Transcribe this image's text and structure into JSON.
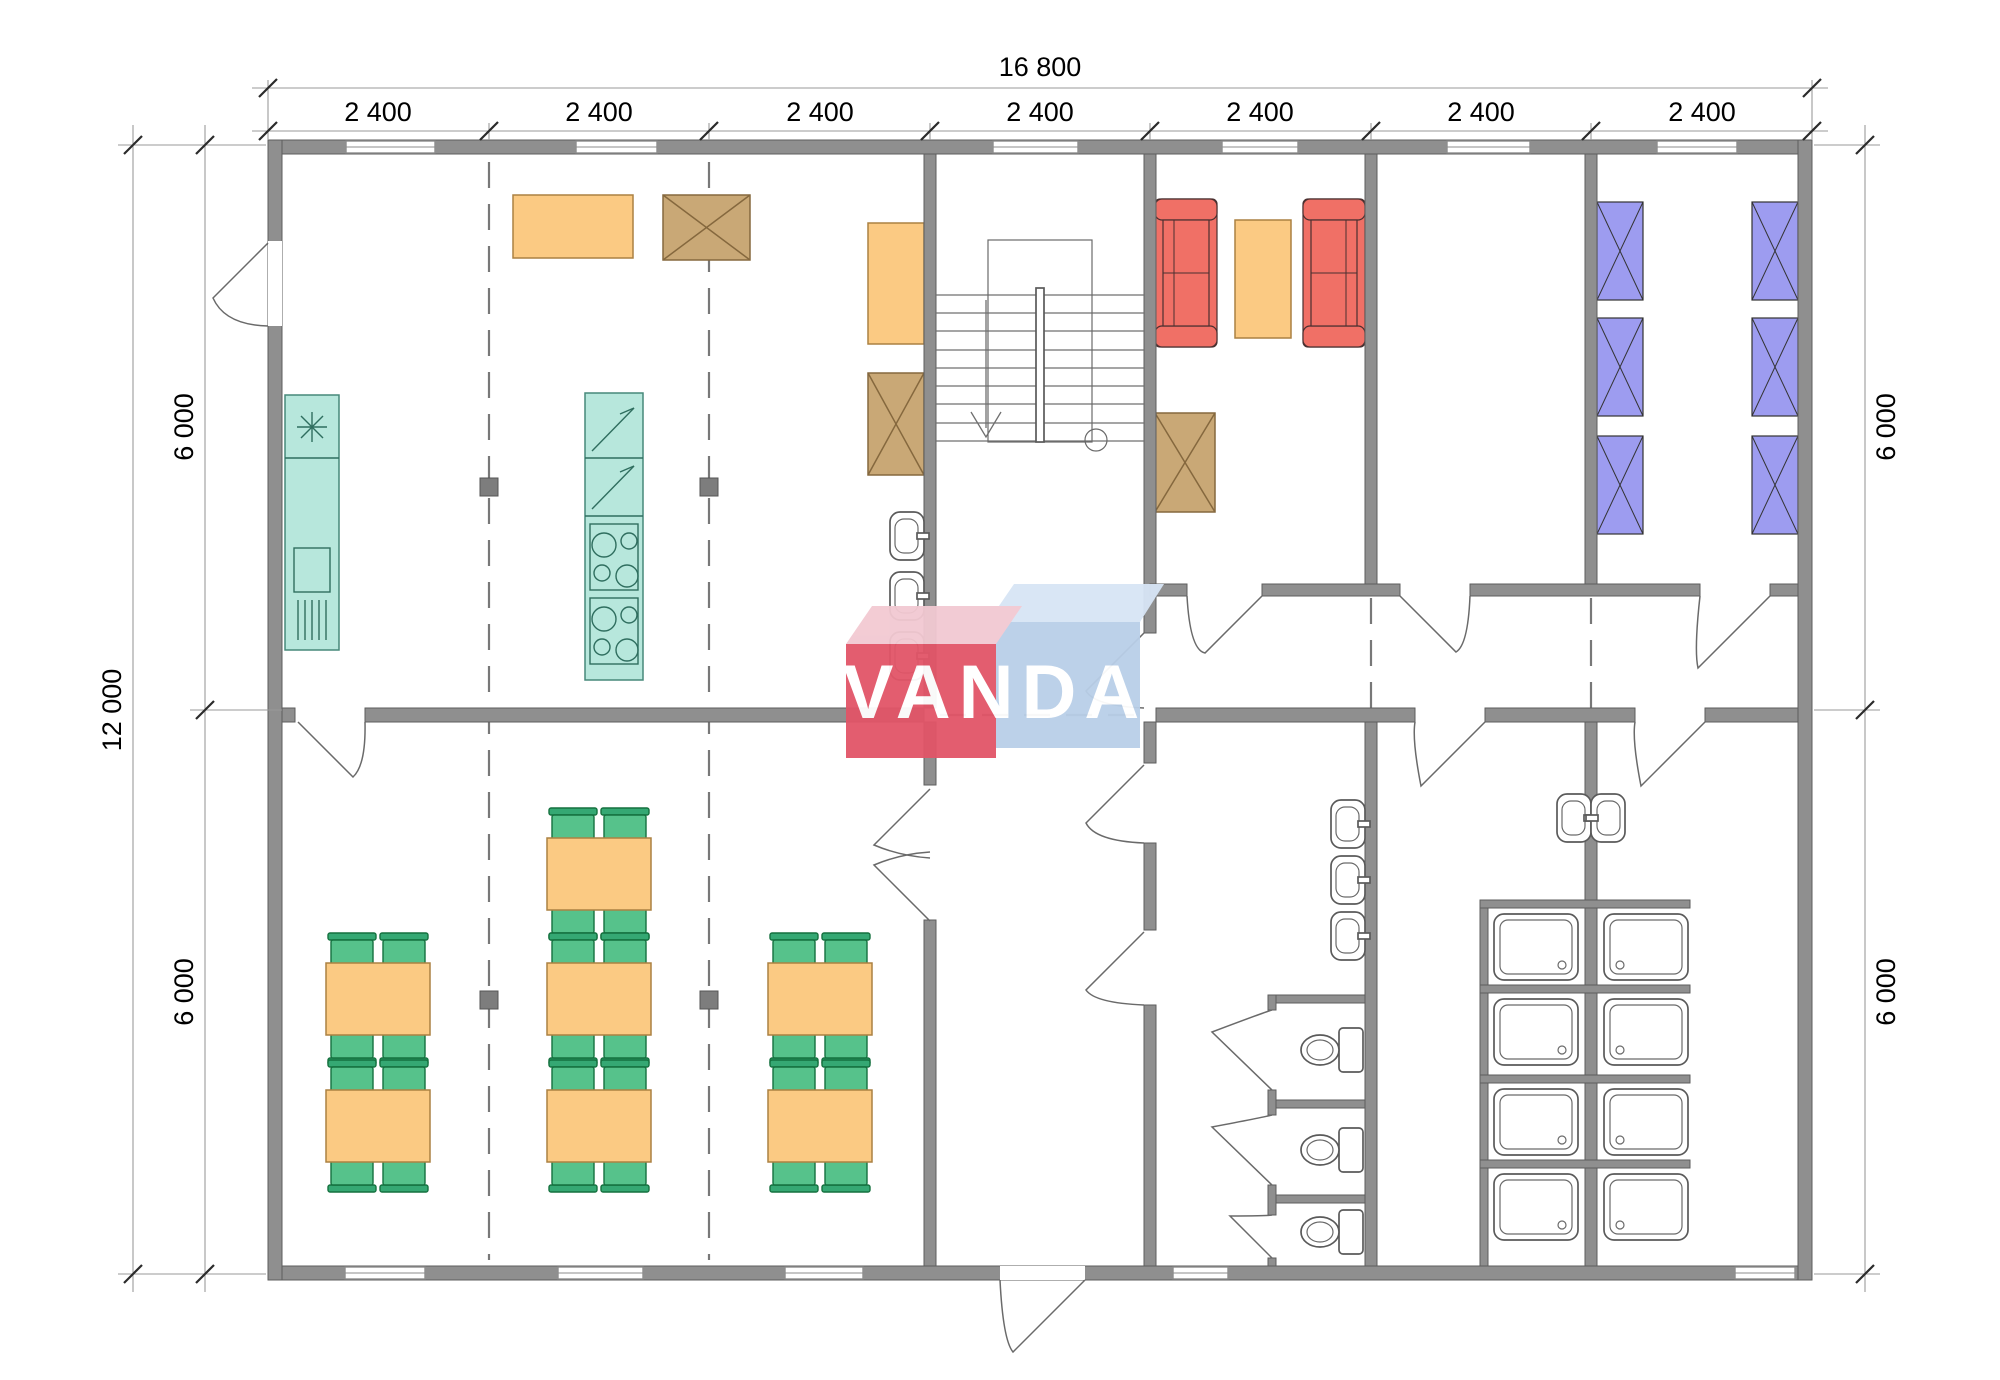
{
  "page": {
    "type": "architectural floor plan drawing",
    "background": "#ffffff"
  },
  "dimensions": {
    "top_total": "16 800",
    "top_segments": [
      "2 400",
      "2 400",
      "2 400",
      "2 400",
      "2 400",
      "2 400",
      "2 400"
    ],
    "left_total": "12 000",
    "left_segments": [
      "6 000",
      "6 000"
    ],
    "right_segments": [
      "6 000",
      "6 000"
    ]
  },
  "watermark": {
    "text": "VANDA"
  },
  "colors": {
    "wall": "#8f8f8f",
    "kitchen_unit": "#b7e7dc",
    "table": "#fbca83",
    "cabinet": "#c9a876",
    "sofa": "#f07066",
    "bed": "#9d9cf0",
    "chair": "#56c28b",
    "logo_red": "#e25568",
    "logo_red_light": "#f2c9d2",
    "logo_blue": "#b9cfe8",
    "logo_blue_light": "#d7e5f5"
  },
  "inventory": {
    "dining_tables": 7,
    "dining_chairs": 28,
    "beds": 6,
    "sofas": 2,
    "coffee_tables": 1,
    "cabinets": 3,
    "kitchen_counters": 2,
    "showers": 8,
    "toilets": 3,
    "wash_basins": 8,
    "staircases": 1
  }
}
